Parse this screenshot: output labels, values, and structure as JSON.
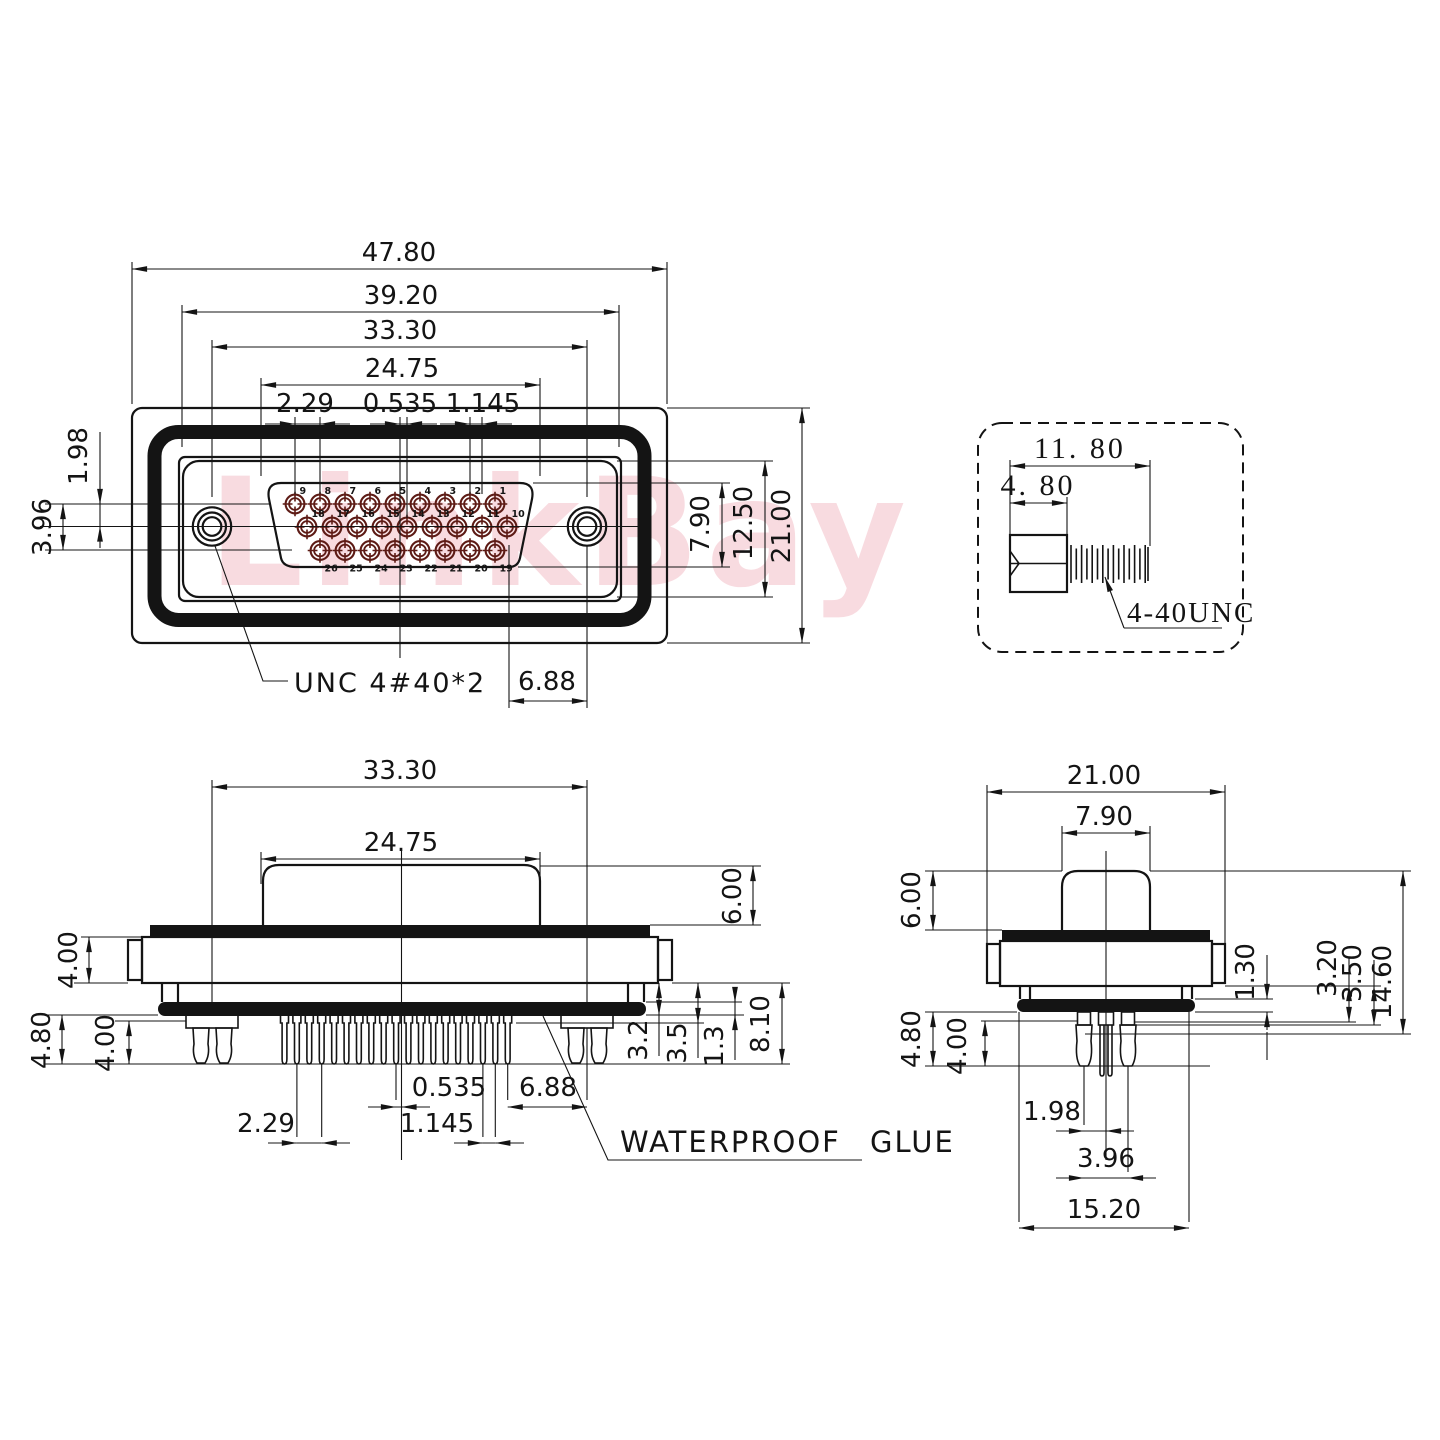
{
  "watermark": {
    "text": "LinkBay",
    "color": "#f3b9c3"
  },
  "colors": {
    "line": "#141414",
    "pin_accent": "#5d1b15",
    "watermark_pink": "#f3b9c3"
  },
  "front_view": {
    "dims": {
      "total_width": "47.80",
      "shell_width": "39.20",
      "screw_span": "33.30",
      "insert_width": "24.75",
      "pin_pitch": "2.29",
      "center_offset": "0.535",
      "half_offset": "1.145",
      "row_pitch": "1.98",
      "rows_span": "3.96",
      "insert_height": "7.90",
      "shell_height": "12.50",
      "total_height": "21.00",
      "screw_to_pin": "6.88"
    },
    "thread_label": "UNC 4#40*2",
    "pin_rows": [
      [
        "9",
        "8",
        "7",
        "6",
        "5",
        "4",
        "3",
        "2",
        "1"
      ],
      [
        "18",
        "17",
        "16",
        "15",
        "14",
        "13",
        "12",
        "11",
        "10"
      ],
      [
        "26",
        "25",
        "24",
        "23",
        "22",
        "21",
        "20",
        "19"
      ]
    ]
  },
  "screw_detail": {
    "dims": {
      "total_length": "11. 80",
      "head_length": "4. 80"
    },
    "thread_label": "4-40UNC"
  },
  "side_view": {
    "dims": {
      "screw_span": "33.30",
      "insert_width": "24.75",
      "cap_height": "6.00",
      "flange_thickness": "4.00",
      "pin_length": "4.80",
      "rivet_length": "4.00",
      "body_step": "3.2",
      "pin_shoulder": "3.5",
      "glue_thickness": "1.3",
      "below_flange": "8.10",
      "center_offset": "0.535",
      "screw_to_pin": "6.88",
      "pin_pitch": "2.29",
      "half_offset": "1.145"
    },
    "glue_label": "WATERPROOF GLUE"
  },
  "end_view": {
    "dims": {
      "total_width": "21.00",
      "insert_width": "7.90",
      "cap_height": "6.00",
      "pin_length": "4.80",
      "rivet_length": "4.00",
      "glue_thickness": "1.30",
      "body_step": "3.20",
      "pin_shoulder": "3.50",
      "overall_height": "14.60",
      "row_pitch": "1.98",
      "rows_span": "3.96",
      "body_width": "15.20"
    }
  }
}
